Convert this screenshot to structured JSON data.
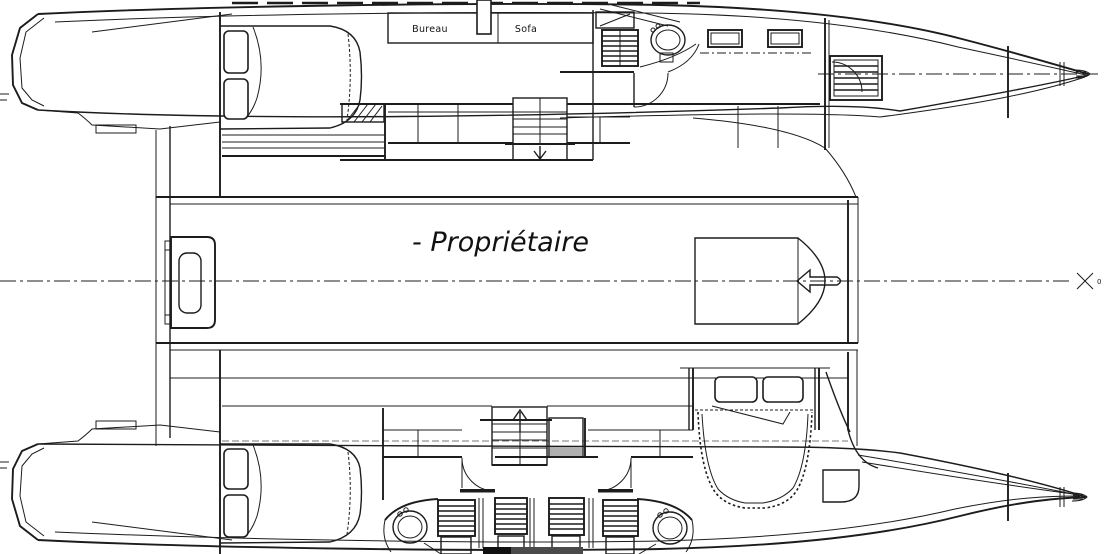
{
  "meta": {
    "type": "catamaran-accommodation-plan",
    "style": "cad-line-drawing",
    "orientation": "bow-right"
  },
  "colors": {
    "background": "#ffffff",
    "line": "#1c1c1c",
    "shade_gray": "#b0b0b0",
    "dark_fill": "#4a4a4a"
  },
  "labels": {
    "desk": "Bureau",
    "sofa": "Sofa",
    "owner": "- Propriétaire",
    "station_zero": "0"
  },
  "hulls": {
    "port_hull": {
      "position": "top",
      "features": [
        "aft-double-bed",
        "desk-console",
        "sofa",
        "companionway-steps",
        "stairs-down",
        "wc",
        "shower-grating",
        "deck-hatches",
        "louvered-locker",
        "bow-bulkheads"
      ]
    },
    "starboard_hull": {
      "position": "bottom",
      "features": [
        "aft-double-bed",
        "stairs-up",
        "two-wc",
        "four-shower-gratings",
        "two-door-swings",
        "forward-double-bed",
        "bow-bulkheads"
      ]
    }
  },
  "bridge_deck": {
    "features": [
      "stern-platform",
      "forward-pod",
      "aft-arrow",
      "owner-suite-label",
      "centerline-station-marker"
    ]
  }
}
